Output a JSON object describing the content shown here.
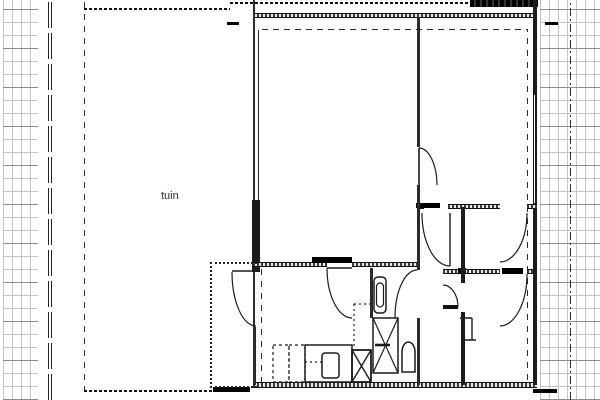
{
  "drawing": {
    "labels": {
      "garden": "tuin"
    },
    "colors": {
      "line": "#1c1c1c",
      "grid": "#c4c4c4",
      "grid_dark": "#8d8d8d",
      "background": "#ffffff"
    },
    "fixture_names": [
      "terrace-dotted-outline",
      "kitchen-unit",
      "kitchen-sink",
      "appliance-space",
      "duct-shaft",
      "shower-tray",
      "washbasin",
      "toilet"
    ]
  }
}
